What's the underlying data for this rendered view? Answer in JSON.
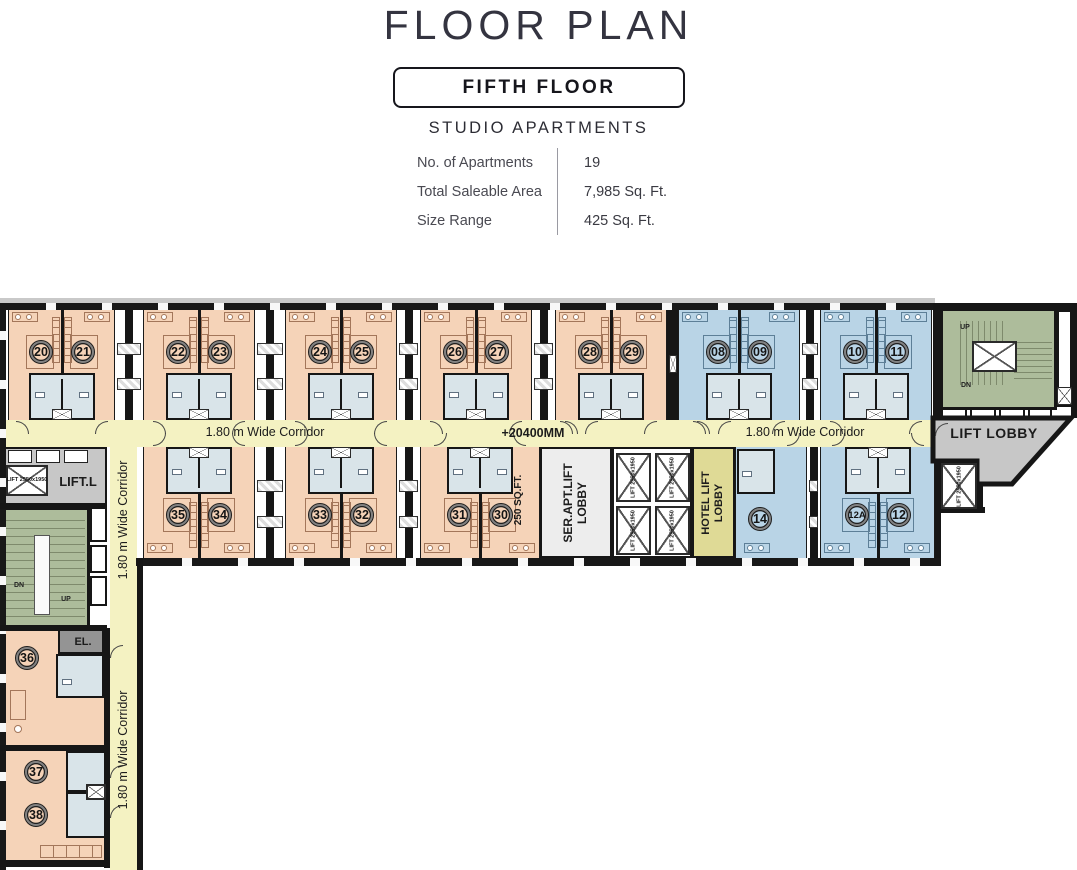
{
  "header": {
    "title": "FLOOR PLAN",
    "floor": "FIFTH FLOOR",
    "subtitle": "STUDIO APARTMENTS",
    "specs": [
      {
        "label": "No. of Apartments",
        "value": "19"
      },
      {
        "label": "Total Saleable Area",
        "value": "7,985 Sq. Ft."
      },
      {
        "label": "Size Range",
        "value": "425 Sq. Ft."
      }
    ]
  },
  "plan": {
    "corridor_labels": {
      "main_left": "1.80 m Wide Corridor",
      "dimension": "+20400MM",
      "main_right": "1.80 m Wide Corridor",
      "vertical_upper": "1.80 m Wide Corridor",
      "vertical_lower": "1.80 m Wide Corridor"
    },
    "area_labels": {
      "lift_lobby": "LIFT LOBBY",
      "lift_l": "LIFT.L",
      "ser_apt_line1": "SER.APT.LIFT",
      "ser_apt_line2": "LOBBY",
      "hotel_line1": "HOTEL LIFT",
      "hotel_line2": "LOBBY",
      "el": "EL.",
      "unit_area": "250 SQ.FT.",
      "lift_size": "LIFT 2550x1950",
      "up": "UP",
      "dn": "DN"
    },
    "rooms": {
      "top_pairs": [
        [
          "20",
          "21"
        ],
        [
          "22",
          "23"
        ],
        [
          "24",
          "25"
        ],
        [
          "26",
          "27"
        ],
        [
          "28",
          "29"
        ],
        [
          "08",
          "09"
        ],
        [
          "10",
          "11"
        ]
      ],
      "top_pair_types": [
        "studio",
        "studio",
        "studio",
        "studio",
        "studio",
        "hotel",
        "hotel"
      ],
      "bottom_pairs": [
        [
          "35",
          "34"
        ],
        [
          "33",
          "32"
        ],
        [
          "31",
          "30"
        ],
        [
          "12A",
          "12"
        ]
      ],
      "bottom_pair_types": [
        "studio",
        "studio",
        "studio",
        "hotel"
      ],
      "single_hotel_room": "14",
      "wing_rooms": [
        "36",
        "37",
        "38"
      ]
    },
    "colors": {
      "studio": "#f5d3b8",
      "hotel": "#b9d4e6",
      "bath": "#d9e4e9",
      "corridor": "#f4f2c2",
      "stair": "#adbc9b",
      "lobby_gray": "#c7c7c7",
      "hotel_lobby": "#dfda96",
      "wall": "#161616"
    }
  }
}
